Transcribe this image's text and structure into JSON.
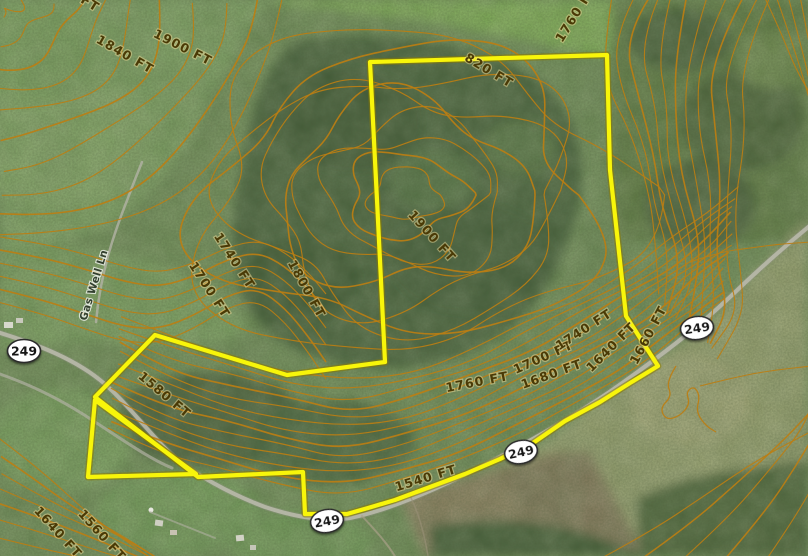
{
  "map": {
    "description": "aerial parcel map with elevation contour overlay",
    "boundary": {
      "color": "#f8f50a",
      "main_points": "370,62 607,55 610,170 626,316 658,366 630,383 600,402 565,421 533,443 500,459 465,474 430,487 395,500 368,508 347,514 305,514 303,472 198,477 95,397 155,335 287,375 385,362 377,200",
      "triangle_points": "95,400 88,477 196,474"
    },
    "contour_labels": [
      {
        "text": "FT",
        "x": 88,
        "y": 7,
        "rot": 32
      },
      {
        "text": "1840 FT",
        "x": 123,
        "y": 58,
        "rot": 30
      },
      {
        "text": "1900 FT",
        "x": 181,
        "y": 51,
        "rot": 27
      },
      {
        "text": "1760 FT",
        "x": 579,
        "y": 16,
        "rot": -58
      },
      {
        "text": "820 FT",
        "x": 487,
        "y": 74,
        "rot": 31
      },
      {
        "text": "1900 FT",
        "x": 429,
        "y": 239,
        "rot": 48
      },
      {
        "text": "1800 FT",
        "x": 303,
        "y": 291,
        "rot": 61
      },
      {
        "text": "1740 FT",
        "x": 231,
        "y": 263,
        "rot": 57
      },
      {
        "text": "1700 FT",
        "x": 206,
        "y": 292,
        "rot": 57
      },
      {
        "text": "1580 FT",
        "x": 162,
        "y": 398,
        "rot": 40
      },
      {
        "text": "1640 FT",
        "x": 55,
        "y": 535,
        "rot": 48
      },
      {
        "text": "1560 FT",
        "x": 99,
        "y": 538,
        "rot": 48
      },
      {
        "text": "1540 FT",
        "x": 427,
        "y": 482,
        "rot": -17
      },
      {
        "text": "1760 FT",
        "x": 478,
        "y": 386,
        "rot": -11
      },
      {
        "text": "1680 FT",
        "x": 553,
        "y": 378,
        "rot": -20
      },
      {
        "text": "1700 FT",
        "x": 545,
        "y": 361,
        "rot": -24
      },
      {
        "text": "1740 FT",
        "x": 586,
        "y": 333,
        "rot": -33
      },
      {
        "text": "1640 FT",
        "x": 614,
        "y": 350,
        "rot": -45
      },
      {
        "text": "1660 FT",
        "x": 652,
        "y": 337,
        "rot": -62
      }
    ],
    "route_shields": [
      {
        "text": "249",
        "x": 24,
        "y": 351,
        "rot": 0
      },
      {
        "text": "249",
        "x": 327,
        "y": 521,
        "rot": -10
      },
      {
        "text": "249",
        "x": 521,
        "y": 452,
        "rot": -12
      },
      {
        "text": "249",
        "x": 697,
        "y": 328,
        "rot": -8
      }
    ],
    "road_labels": [
      {
        "text": "Gas Well Ln",
        "x": 97,
        "y": 286,
        "rot": -73
      }
    ],
    "colors": {
      "contour": "#bc7e12",
      "road": "#b9b9ab",
      "contour_label": "#4a3a06",
      "shield_text": "#171717"
    }
  }
}
